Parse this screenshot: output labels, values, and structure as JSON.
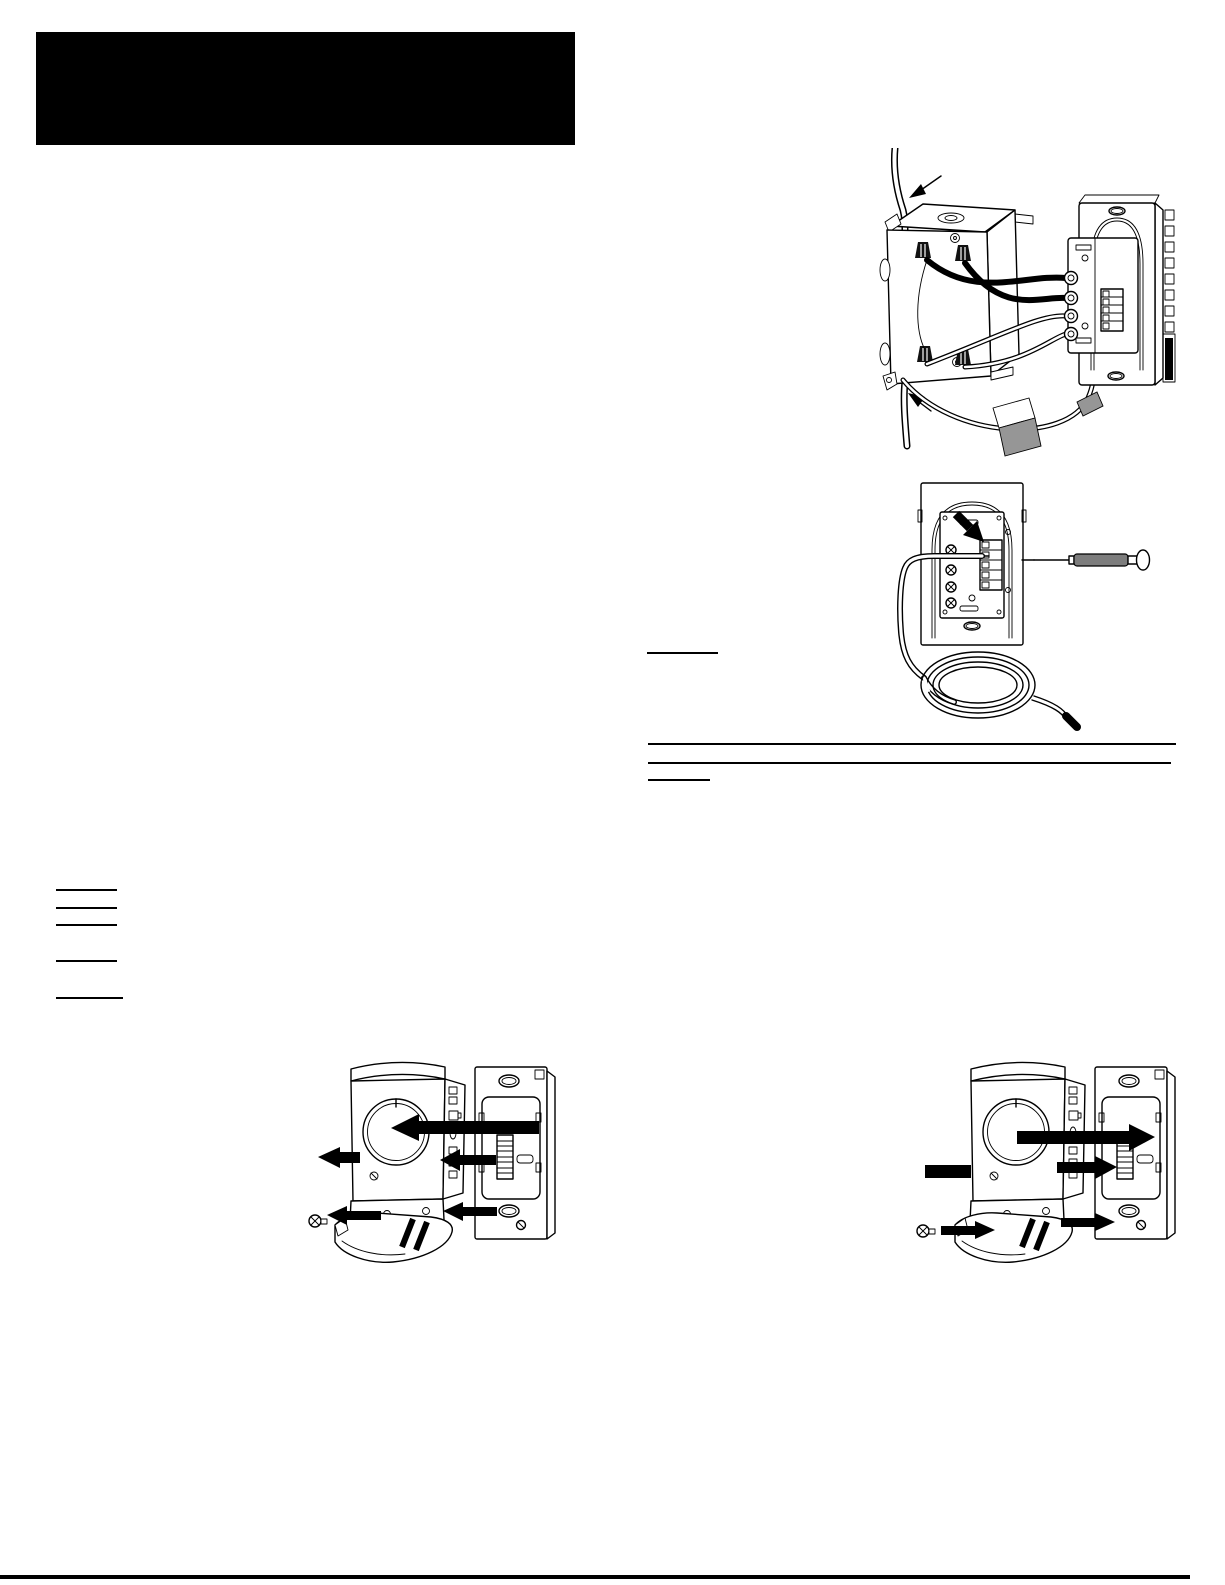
{
  "document": {
    "kind": "thermostat installation manual page (all text removed)",
    "background": "#ffffff",
    "ink": "#000000",
    "shade_gray": "#969696",
    "handle_gray": "#7d7d7d"
  },
  "header_block": {
    "x": 36,
    "y": 32,
    "width": 539,
    "height": 113,
    "color": "#000000"
  },
  "figures": [
    {
      "name": "figure-junction-box-wiring",
      "desc": "wall junction box wired to thermostat power base",
      "left": 845,
      "top": 148,
      "width": 340,
      "height": 315
    },
    {
      "name": "figure-sensor-wire-terminal",
      "desc": "remote sensor wire into wallplate terminal with screwdriver and coiled cable",
      "left": 872,
      "top": 470,
      "width": 320,
      "height": 265
    },
    {
      "name": "figure-thermostat-removal",
      "desc": "thermostat body removed from wallplate, arrows left",
      "left": 285,
      "top": 1035,
      "width": 300,
      "height": 235
    },
    {
      "name": "figure-thermostat-installation",
      "desc": "thermostat body installed on wallplate, arrows right",
      "left": 905,
      "top": 1035,
      "width": 300,
      "height": 235
    }
  ],
  "lines": [
    {
      "name": "underline-right-column-a",
      "x": 647,
      "y": 652,
      "w": 71,
      "h": 2
    },
    {
      "name": "rule-right-column-top",
      "x": 648,
      "y": 743,
      "w": 528,
      "h": 2
    },
    {
      "name": "rule-right-column-bottom",
      "x": 648,
      "y": 762,
      "w": 523,
      "h": 2
    },
    {
      "name": "underline-right-column-b",
      "x": 648,
      "y": 779,
      "w": 62,
      "h": 2
    },
    {
      "name": "underline-left-column-1",
      "x": 56,
      "y": 889,
      "w": 61,
      "h": 2
    },
    {
      "name": "underline-left-column-2",
      "x": 56,
      "y": 907,
      "w": 61,
      "h": 2
    },
    {
      "name": "underline-left-column-3",
      "x": 56,
      "y": 924,
      "w": 61,
      "h": 2
    },
    {
      "name": "underline-left-column-4",
      "x": 56,
      "y": 960,
      "w": 61,
      "h": 2
    },
    {
      "name": "underline-left-column-5",
      "x": 56,
      "y": 997,
      "w": 67,
      "h": 2
    },
    {
      "name": "rule-page-footer",
      "x": 0,
      "y": 1575,
      "w": 1190,
      "h": 4
    }
  ]
}
